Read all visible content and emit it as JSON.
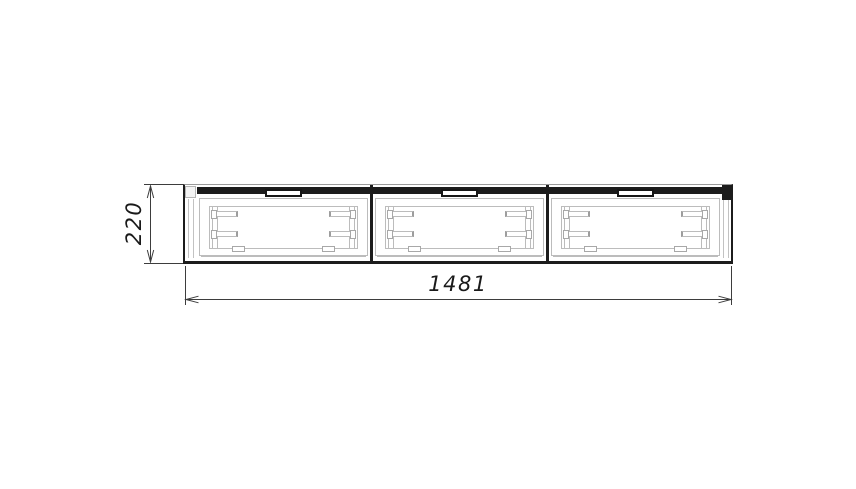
{
  "drawing": {
    "type": "technical-front-view",
    "object": "three-drawer wall cabinet",
    "sections": 3,
    "dimensions": {
      "width": {
        "value": "1481"
      },
      "height": {
        "value": "220"
      }
    },
    "colors": {
      "outline": "#1c1c1c",
      "detail_lines": "#bcbcbc",
      "dimension_lines": "#3d3d3d",
      "text": "#1a1a1a",
      "background": "#ffffff"
    }
  }
}
